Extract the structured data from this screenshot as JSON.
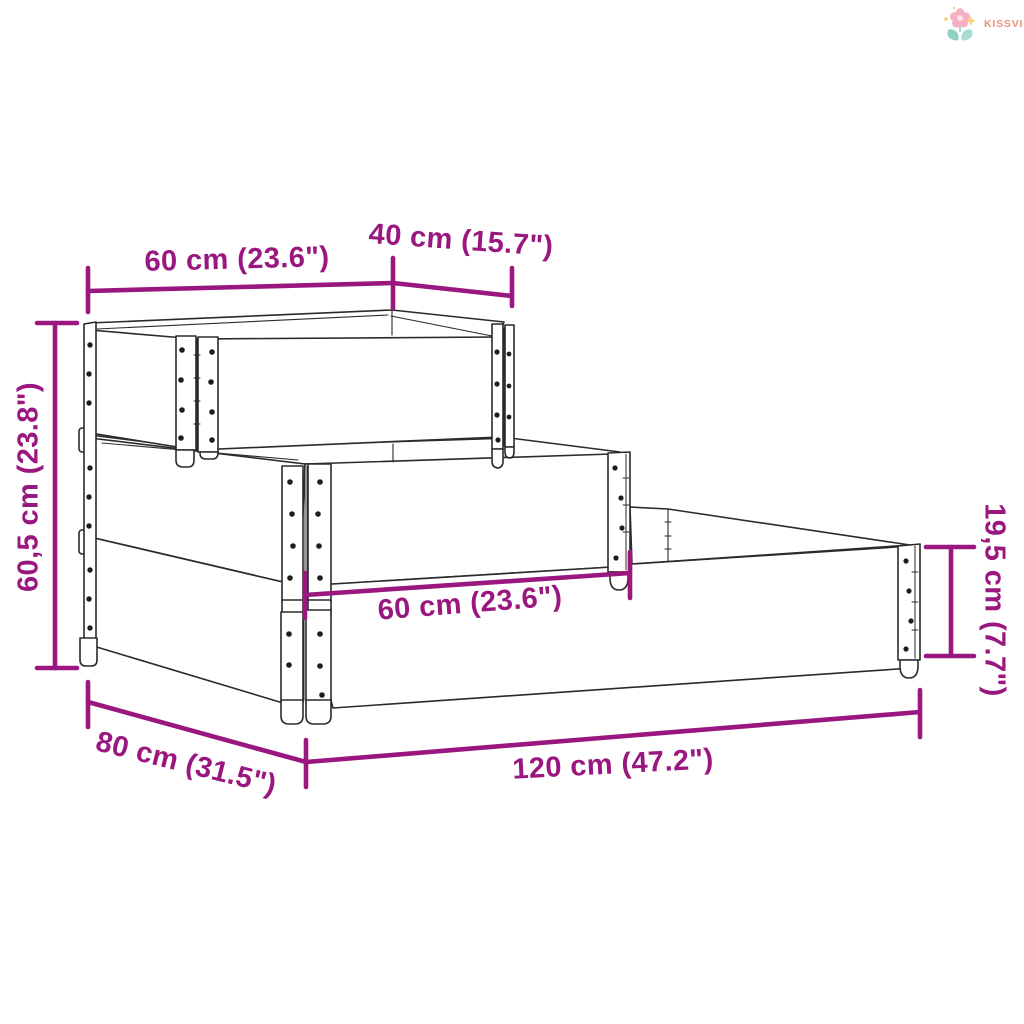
{
  "logo": {
    "brand": "KISSVILÁG"
  },
  "colors": {
    "dimension_annotation": "#9A1780",
    "drawing_line": "#2B2B2B",
    "logo_text": "#F0907D",
    "logo_petal": "#F6AFC2",
    "logo_leaf": "#8FD0C2",
    "logo_sparkle": "#F6D36E"
  },
  "dimensions": {
    "top_width": "60 cm (23.6\")",
    "top_depth": "40 cm (15.7\")",
    "total_height": "60,5 cm (23.8\")",
    "middle_width": "60 cm (23.6\")",
    "collar_height": "19,5 cm (7.7\")",
    "base_depth": "80 cm (31.5\")",
    "base_length": "120 cm (47.2\")"
  }
}
